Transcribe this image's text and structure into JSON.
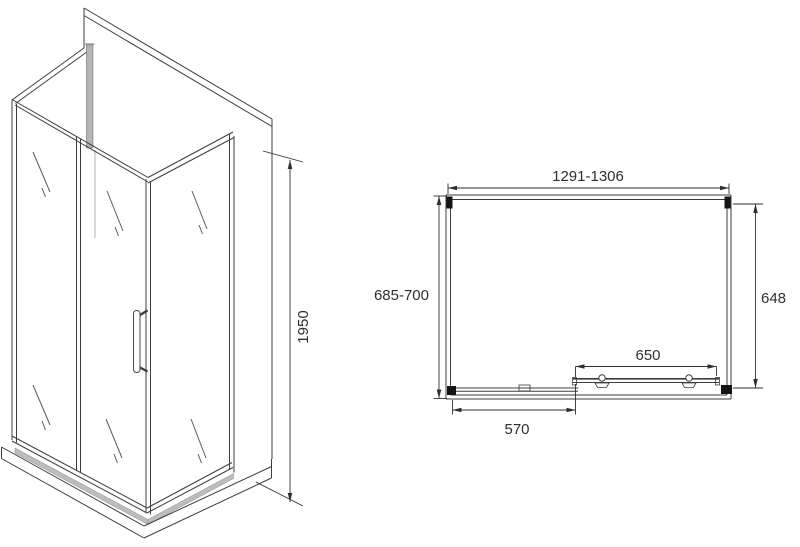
{
  "page": {
    "background": "#ffffff"
  },
  "views": {
    "isometric": {
      "name": "isometric-view",
      "height_dim": "1950"
    },
    "plan": {
      "name": "plan-view",
      "width_dim": "1291-1306",
      "depth_dim": "685-700",
      "right_glass_dim": "648",
      "door_dim": "650",
      "fixed_panel_dim": "570"
    }
  },
  "style": {
    "line_color": "#3d3d3d",
    "dim_color": "#2f2f2f",
    "profile_black": "#141414",
    "profile_gray": "#b5b5b5",
    "glass_band_gray": "#bdbdbd",
    "background": "#ffffff"
  }
}
